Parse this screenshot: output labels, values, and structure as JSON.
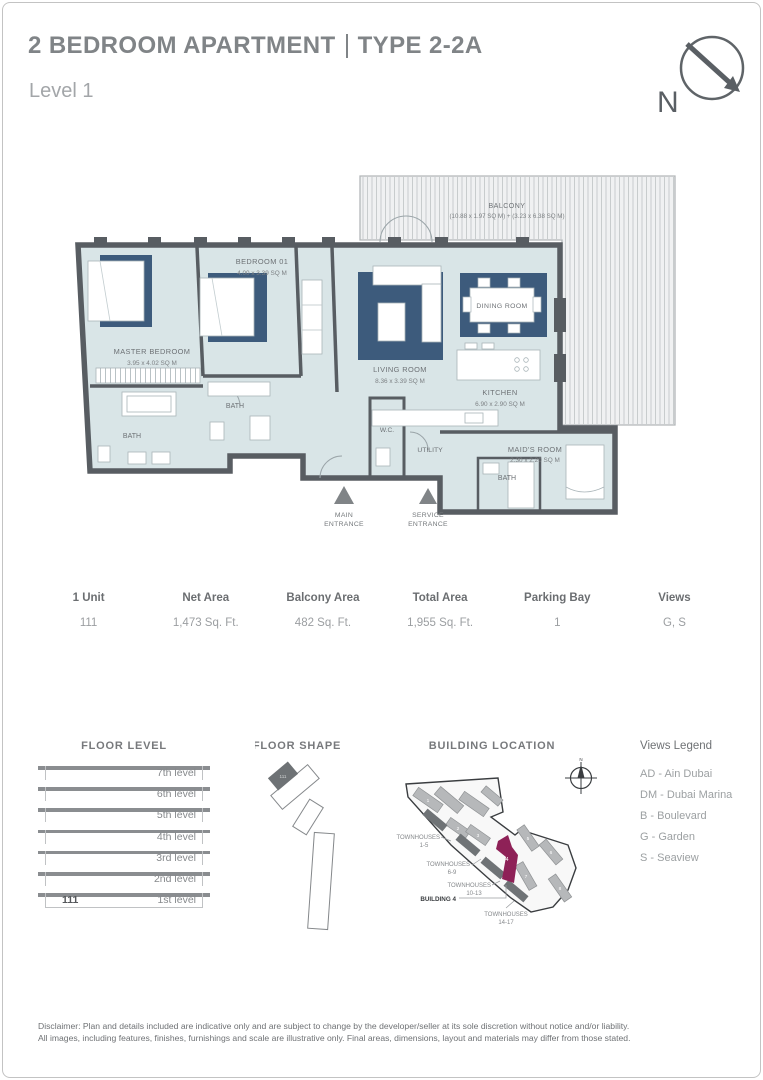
{
  "header": {
    "title_main": "2 BEDROOM APARTMENT",
    "title_type": "TYPE 2-2A",
    "subtitle": "Level 1",
    "north_label": "N"
  },
  "floorplan": {
    "balcony_name": "BALCONY",
    "balcony_dims": "(10.88 x 1.97 SQ M) + (3.23 x 6.38 SQ M)",
    "master_name": "MASTER BEDROOM",
    "master_dims": "3.95 x 4.02 SQ M",
    "bedroom01_name": "BEDROOM 01",
    "bedroom01_dims": "4.00 x 3.39 SQ M",
    "living_name": "LIVING ROOM",
    "living_dims": "8.36 x 3.39 SQ M",
    "dining_name": "DINING ROOM",
    "kitchen_name": "KITCHEN",
    "kitchen_dims": "6.90 x 2.90 SQ M",
    "maids_name": "MAID'S ROOM",
    "maids_dims": "2.30 x 2.20 SQ M",
    "bath_master": "BATH",
    "bath_bedroom": "BATH",
    "bath_maid": "BATH",
    "wc": "W.C.",
    "utility": "UTILITY",
    "main_entrance_line1": "MAIN",
    "main_entrance_line2": "ENTRANCE",
    "service_entrance_line1": "SERVICE",
    "service_entrance_line2": "ENTRANCE"
  },
  "unit_table": {
    "columns": [
      {
        "header": "1 Unit",
        "value": "111"
      },
      {
        "header": "Net Area",
        "value": "1,473 Sq. Ft."
      },
      {
        "header": "Balcony Area",
        "value": "482 Sq. Ft."
      },
      {
        "header": "Total Area",
        "value": "1,955 Sq. Ft."
      },
      {
        "header": "Parking Bay",
        "value": "1"
      },
      {
        "header": "Views",
        "value": "G, S"
      }
    ]
  },
  "floor_level": {
    "title": "FLOOR LEVEL",
    "unit": "111",
    "levels": [
      "7th level",
      "6th level",
      "5th level",
      "4th level",
      "3rd level",
      "2nd level",
      "1st level"
    ]
  },
  "floor_shape": {
    "title": "FLOOR SHAPE",
    "unit_number": "111"
  },
  "building_location": {
    "title": "BUILDING LOCATION",
    "compass_label": "N",
    "highlight_number": "4",
    "building_numbers": [
      "1",
      "2",
      "3",
      "5",
      "6",
      "7",
      "8"
    ],
    "labels": {
      "th1_line1": "TOWNHOUSES",
      "th1_line2": "1-5",
      "th2_line1": "TOWNHOUSES",
      "th2_line2": "6-9",
      "th3_line1": "TOWNHOUSES",
      "th3_line2": "10-13",
      "building4": "BUILDING 4",
      "th4_line1": "TOWNHOUSES",
      "th4_line2": "14-17"
    }
  },
  "views_legend": {
    "title": "Views Legend",
    "items": [
      "AD - Ain Dubai",
      "DM - Dubai Marina",
      "B - Boulevard",
      "G - Garden",
      "S - Seaview"
    ]
  },
  "disclaimer": {
    "line1": "Disclaimer: Plan and details included are indicative only and are subject to change by the developer/seller at its sole discretion without notice and/or liability.",
    "line2": "All images, including features, finishes, furnishings and scale are illustrative only. Final areas, dimensions, layout and materials may differ from those stated."
  },
  "colors": {
    "accent_blue": "#3d5b7c",
    "wall": "#585d62",
    "interior": "#d9e5e7",
    "highlight_magenta": "#8e2157"
  }
}
